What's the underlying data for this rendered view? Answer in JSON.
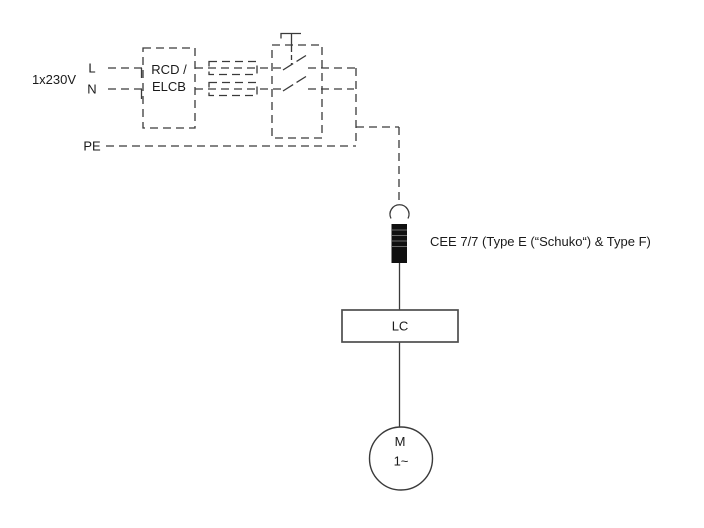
{
  "colors": {
    "line": "#3a3a3a",
    "text": "#1a1a1a",
    "plug_body": "#101010",
    "plug_ridge": "#6a6a6a",
    "lc_border": "#4d4d4d",
    "background": "#ffffff"
  },
  "diagram": {
    "supply": {
      "voltage_label": "1x230V",
      "line_l_label": "L",
      "line_n_label": "N",
      "line_pe_label": "PE"
    },
    "rcd_block": {
      "label_line1": "RCD /",
      "label_line2": "ELCB"
    },
    "plug": {
      "label": "CEE 7/7 (Type E (“Schuko“) & Type F)"
    },
    "line_choke_block": {
      "label": "LC"
    },
    "motor": {
      "symbol": "M",
      "phase_label": "1~"
    }
  }
}
